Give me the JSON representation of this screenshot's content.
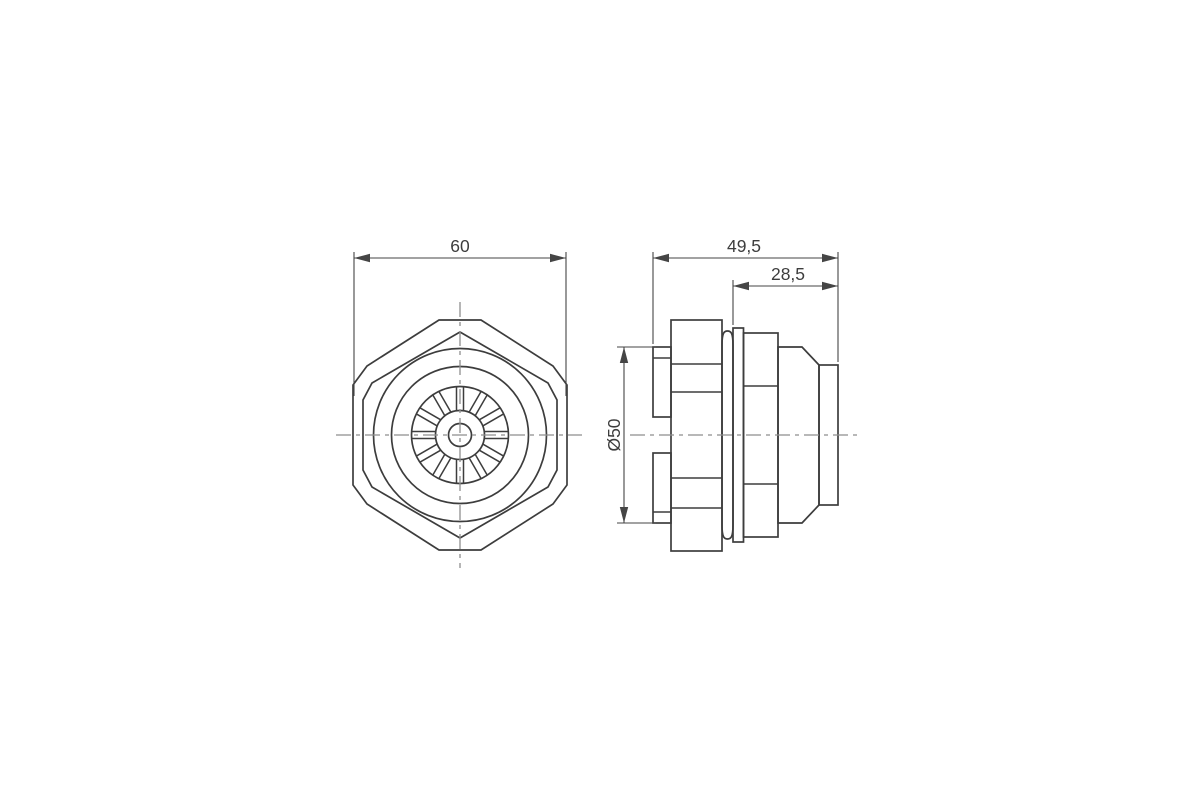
{
  "drawing": {
    "kind": "technical drawing — cable gland, front and side view",
    "dimensions": {
      "across_flats": "60",
      "overall_length": "49,5",
      "partial_length": "28,5",
      "flange_diameter": "Ø50"
    }
  },
  "style": {
    "line_color": "#3d3d3d",
    "dim_color": "#454545",
    "centerline_color": "#8e8e8e",
    "text_color": "#3d3d3d",
    "background": "#ffffff"
  }
}
